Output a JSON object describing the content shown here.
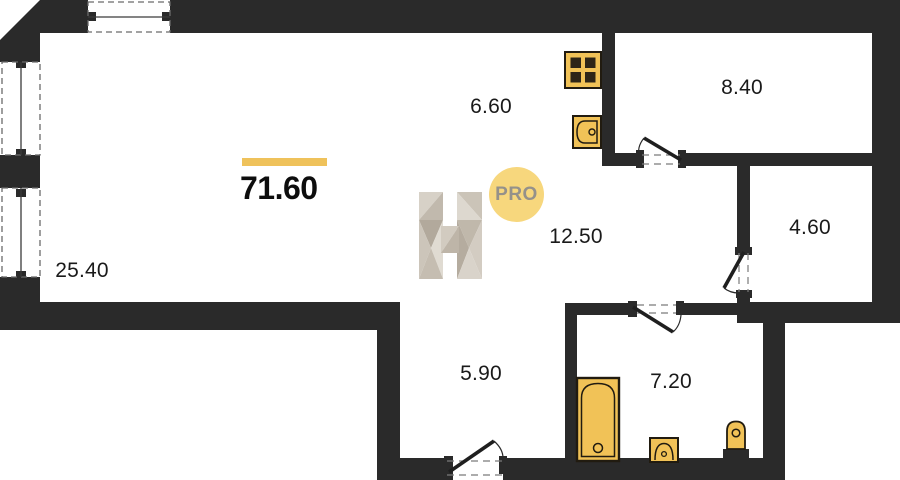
{
  "floor_plan": {
    "total": {
      "area": "71.60",
      "underline_color": "#efc25b"
    },
    "rooms": [
      {
        "id": "living-room",
        "area": "25.40"
      },
      {
        "id": "kitchen",
        "area": "6.60"
      },
      {
        "id": "bedroom",
        "area": "8.40"
      },
      {
        "id": "storage",
        "area": "4.60"
      },
      {
        "id": "hall",
        "area": "12.50"
      },
      {
        "id": "corridor",
        "area": "5.90"
      },
      {
        "id": "bathroom",
        "area": "7.20"
      }
    ],
    "watermark": {
      "logo": "H",
      "badge_label": "PRO",
      "badge_color": "#f7d77d",
      "badge_text_color": "#95918a"
    },
    "colors": {
      "wall": "#2a2a2a",
      "fixture_fill": "#f1c257",
      "background": "#ffffff"
    },
    "icons": [
      "stove-icon",
      "kitchen-sink-icon",
      "bathtub-icon",
      "washbasin-icon",
      "toilet-icon",
      "door-arc-icon",
      "window-icon"
    ]
  }
}
